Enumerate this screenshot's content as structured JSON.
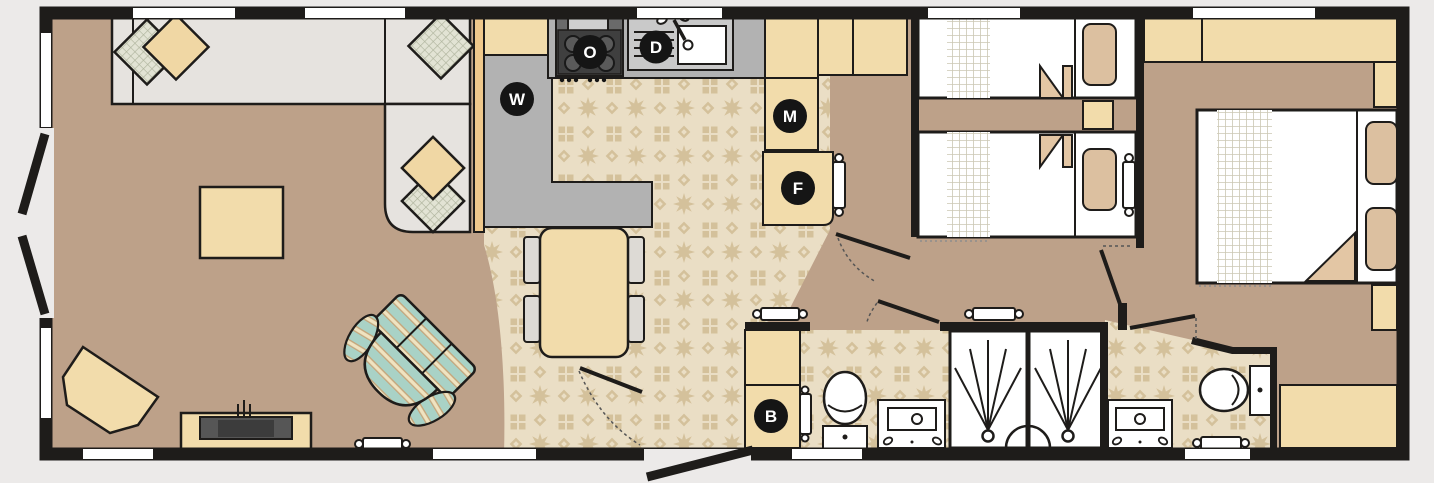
{
  "plan": {
    "badges": {
      "washing_machine": "W",
      "oven": "O",
      "dishwasher": "D",
      "microwave": "M",
      "fridge_freezer": "F",
      "boiler": "B"
    },
    "colors": {
      "background": "#ECEAE9",
      "wall": "#1E1C1A",
      "carpet": "#BDA189",
      "tile_base": "#EADEC5",
      "tile_motif": "#D4C19B",
      "furniture_beige": "#F2DCAB",
      "sofa_grey": "#E6E3DF",
      "worktop_grey": "#B2B2B2",
      "armchair_teal": "#A9D2C6",
      "pillow_tan": "#DCC0A0",
      "partition_tan": "#F0C98C",
      "badge_black": "#151515"
    }
  }
}
